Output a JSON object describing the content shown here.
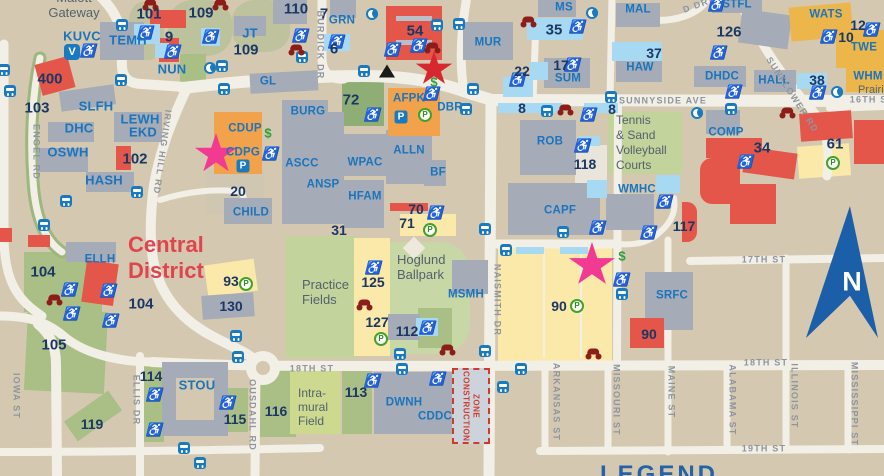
{
  "colors": {
    "background": "#d4c9b0",
    "road": "#f2efe6",
    "building_gray": "#a5abb7",
    "building_red": "#e4564a",
    "building_orange": "#f2a24b",
    "building_gold": "#edb64a",
    "parking_yellow": "#fbe9a9",
    "field_green": "#b9cc96",
    "accessible_blue": "#a7d9f2",
    "code_blue": "#1b75bc",
    "number_navy": "#1b3764",
    "road_label_gray": "#8e959e",
    "area_label_slate": "#53626c",
    "district_red": "#e0454e",
    "compass_blue": "#1b5fa8",
    "construction_red": "#d03a2e",
    "moto_maroon": "#8c1d18",
    "money_green": "#2e9e3e",
    "permit_green": "#43a127",
    "legend_blue": "#2563a8",
    "star_red": "#d7282f",
    "star_pink": "#f23a93"
  },
  "icons": {
    "accessibility": "♿",
    "parking": "P",
    "permit": "P",
    "van_shuttle": "V",
    "dollar": "$"
  },
  "compass": {
    "label": "N"
  },
  "legend": {
    "title": "LEGEND"
  },
  "district": {
    "line1": "Central",
    "line2": "District"
  },
  "construction": {
    "line1": "CONSTRUCTION",
    "line2": "ZONE"
  },
  "areas": {
    "malott": "Malott",
    "gateway": "Gateway",
    "practice": [
      "Practice",
      "Fields"
    ],
    "hoglund": [
      "Hoglund",
      "Ballpark"
    ],
    "tennis": [
      "Tennis",
      "& Sand",
      "Volleyball",
      "Courts"
    ],
    "intramural": [
      "Intra-",
      "mural",
      "Field"
    ],
    "prairie": "Prairie"
  },
  "roads": {
    "engel": "ENGEL RD",
    "irving_hill": "IRVING HILL RD",
    "burdick": "BURDICK DR",
    "sunnyside": "SUNNYSIDE AVE",
    "sunflower": "SUNFLOWER RD",
    "st16": "16TH ST",
    "st17": "17TH ST",
    "st18": "18TH ST",
    "st19": "19TH ST",
    "naismith": "NAISMITH DR",
    "iowa": "IOWA ST",
    "ellis": "ELLIS DR",
    "ousdahl": "OUSDAHL RD",
    "arkansas": "ARKANSAS ST",
    "missouri": "MISSOURI ST",
    "maine": "MAINE ST",
    "alabama": "ALABAMA ST",
    "illinois": "ILLINOIS ST",
    "mississippi": "MISSISSIPPI ST",
    "partial": "D DR"
  },
  "buildings": {
    "kuvc": "KUVC",
    "temh": "TEMH",
    "nun": "NUN",
    "slfh": "SLFH",
    "lewh": "LEWH",
    "ekd": "EKD",
    "dhc": "DHC",
    "oswh": "OSWH",
    "hash": "HASH",
    "ellh": "ELLH",
    "jt": "JT",
    "grn": "GRN",
    "gl": "GL",
    "burg": "BURG",
    "cdup": "CDUP",
    "cdpg": "CDPG",
    "child": "CHILD",
    "ascc": "ASCC",
    "ansp": "ANSP",
    "wpac": "WPAC",
    "hfam": "HFAM",
    "alln": "ALLN",
    "bf": "BF",
    "afpk": "AFPK",
    "dbr": "DBR",
    "mur": "MUR",
    "ms": "MS",
    "sum": "SUM",
    "haw": "HAW",
    "mal": "MAL",
    "stfl": "STFL",
    "wats": "WATS",
    "twe": "TWE",
    "dhdc": "DHDC",
    "hall": "HALL",
    "whm": "WHM",
    "comp": "COMP",
    "rob": "ROB",
    "capf": "CAPF",
    "wmhc": "WMHC",
    "srfc": "SRFC",
    "msmh": "MSMH",
    "stou": "STOU",
    "dwnh": "DWNH",
    "cddc": "CDDC"
  },
  "lots": {
    "101": "101",
    "102": "102",
    "103": "103",
    "104": "104",
    "105": "105",
    "109": "109",
    "110": "110",
    "112": "112",
    "113": "113",
    "114": "114",
    "115": "115",
    "116": "116",
    "117": "117",
    "118": "118",
    "119": "119",
    "125": "125",
    "126": "126",
    "127": "127",
    "130": "130",
    "400": "400",
    "6": "6",
    "7": "7",
    "8": "8",
    "9": "9",
    "10": "10",
    "12": "12",
    "17": "17",
    "20": "20",
    "22": "22",
    "31": "31",
    "34": "34",
    "35": "35",
    "37": "37",
    "38": "38",
    "54": "54",
    "61": "61",
    "70": "70",
    "71": "71",
    "72": "72",
    "90": "90",
    "93": "93"
  }
}
